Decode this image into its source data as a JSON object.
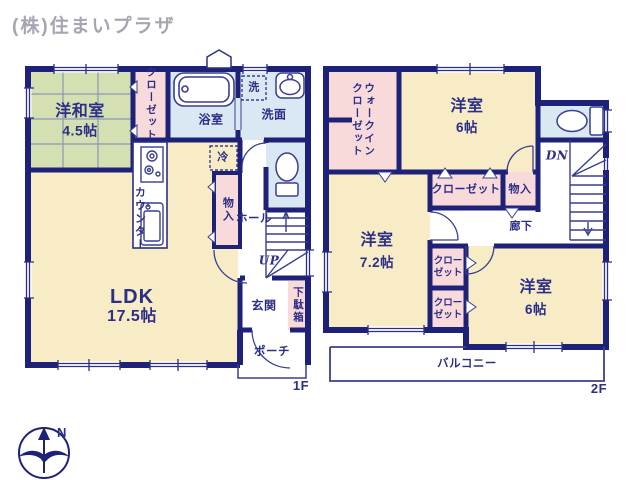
{
  "company": "(株)住まいプラザ",
  "floor1": {
    "label": "1F",
    "rooms": {
      "washitsu": {
        "name": "洋和室",
        "size": "4.5帖"
      },
      "closet": "クローゼット",
      "bath": "浴室",
      "washroom": "洗面",
      "laundry": "洗",
      "fridge": "冷",
      "ldk": {
        "name": "LDK",
        "size": "17.5帖"
      },
      "counter": "カウンター",
      "storage": "物入",
      "hall": "ホール",
      "stairs_up": "UP",
      "entrance": "玄関",
      "shoe_box": "下駄箱",
      "porch": "ポーチ"
    }
  },
  "floor2": {
    "label": "2F",
    "rooms": {
      "walk_in_closet": "ウォークイン\nクローゼット",
      "bedroom1": {
        "name": "洋室",
        "size": "6帖"
      },
      "bedroom2": {
        "name": "洋室",
        "size": "7.2帖"
      },
      "bedroom3": {
        "name": "洋室",
        "size": "6帖"
      },
      "closet_wide": "クローゼット",
      "storage": "物入",
      "hallway": "廊下",
      "stairs_down": "DN",
      "closet_a": "クロー\nゼット",
      "closet_b": "クロー\nゼット",
      "balcony": "バルコニー"
    }
  },
  "compass": {
    "north": "N"
  },
  "colors": {
    "wall": "#1e2178",
    "text": "#2b2f87",
    "tatami": "#d5e0b2",
    "room": "#f8ecc7",
    "closet": "#f9dada",
    "wet": "#d9e8f3"
  }
}
